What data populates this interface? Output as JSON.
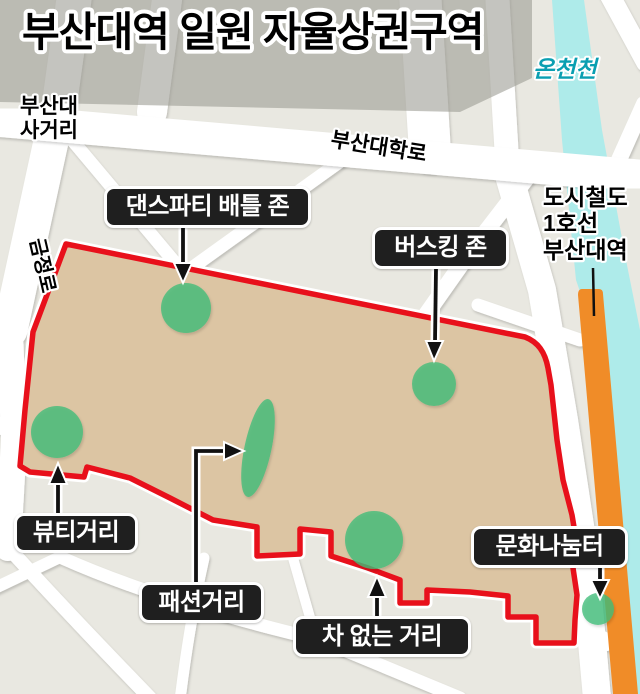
{
  "title": "부산대역 일원 자율상권구역",
  "labels": {
    "stream": "온천천",
    "intersection_line1": "부산대",
    "intersection_line2": "사거리",
    "main_road": "부산대학로",
    "left_road": "금정로",
    "subway_line1": "도시철도",
    "subway_line2": "1호선",
    "subway_line3": "부산대역"
  },
  "zones": {
    "dance": {
      "label": "댄스파티 배틀 존"
    },
    "busking": {
      "label": "버스킹 존"
    },
    "beauty": {
      "label": "뷰티거리"
    },
    "fashion": {
      "label": "패션거리"
    },
    "car_free": {
      "label": "차 없는 거리"
    },
    "culture": {
      "label": "문화나눔터"
    }
  },
  "colors": {
    "district_outline": "#e8101b",
    "district_fill": "#dcc5a3",
    "inner_street": "#fbeedd",
    "zone_green": "#3fbc78",
    "stream_cyan": "#aeebea",
    "stream_text": "#0a9fb1",
    "subway_road_orange": "#f08c28",
    "campus_block_gray": "#9d9d95",
    "block_base": "#e9e8e1",
    "street_white": "#ffffff",
    "badge_bg": "#1f1f1f",
    "badge_text": "#ffffff"
  }
}
